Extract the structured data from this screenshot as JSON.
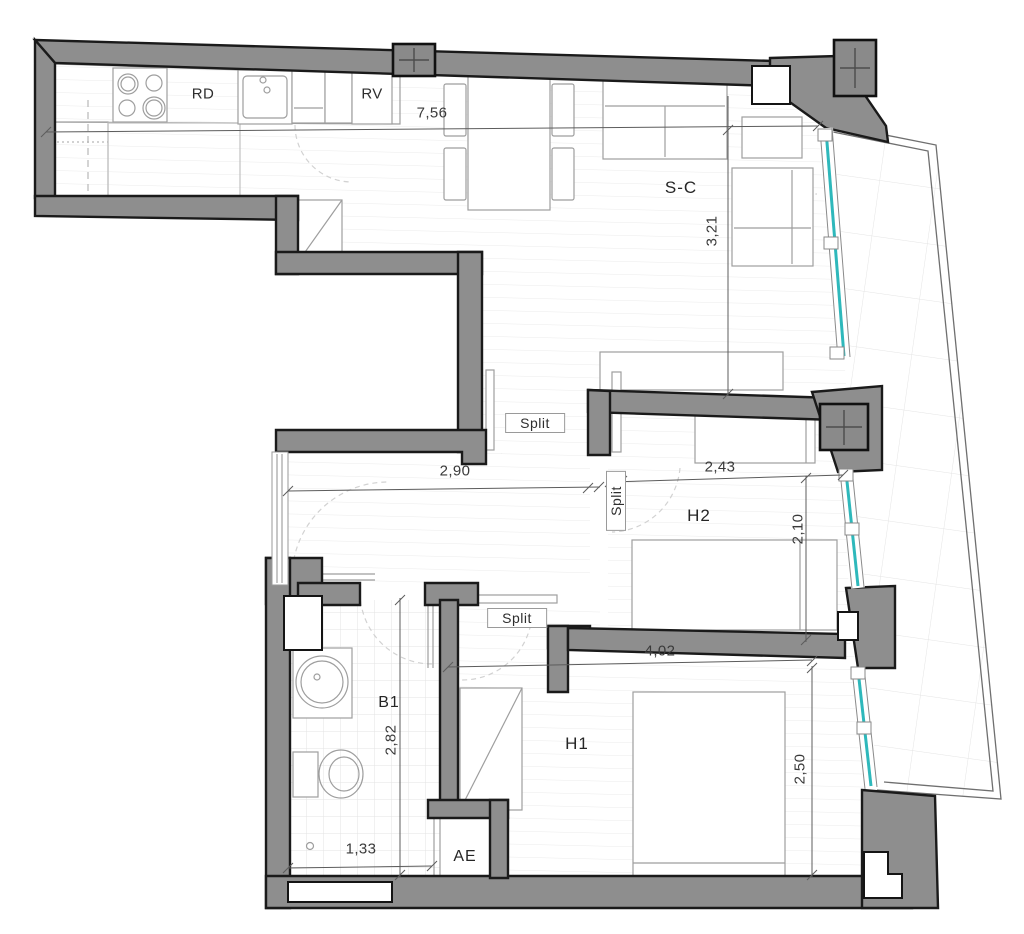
{
  "title": "Apartment floor plan",
  "colors": {
    "wall": "#8e8e8e",
    "wall_outline": "#1a1a1a",
    "glazing": "#2eb8bb",
    "furniture_line": "#9e9e9e",
    "dimension_line": "#5c5c5c",
    "floor_line": "#ebebeb",
    "text": "#2e2e2e"
  },
  "rooms": {
    "living_dining": {
      "label": "S-C"
    },
    "bedroom_1": {
      "label": "H1"
    },
    "bedroom_2": {
      "label": "H2"
    },
    "bathroom": {
      "label": "B1"
    },
    "storage": {
      "label": "AE"
    }
  },
  "kitchen": {
    "counter_label": "RD",
    "fridge_label": "RV"
  },
  "ac_units": {
    "unit_1": "Split",
    "unit_2": "Split",
    "unit_3": "Split"
  },
  "dimensions": {
    "living_width": "7,56",
    "living_depth": "3,21",
    "hall_width": "2,90",
    "wardrobe_width": "2,43",
    "bedroom2_depth": "2,10",
    "bedroom1_width": "4,02",
    "bathroom_depth": "2,82",
    "bedroom1_depth": "2,50",
    "bathroom_width": "1,33"
  }
}
